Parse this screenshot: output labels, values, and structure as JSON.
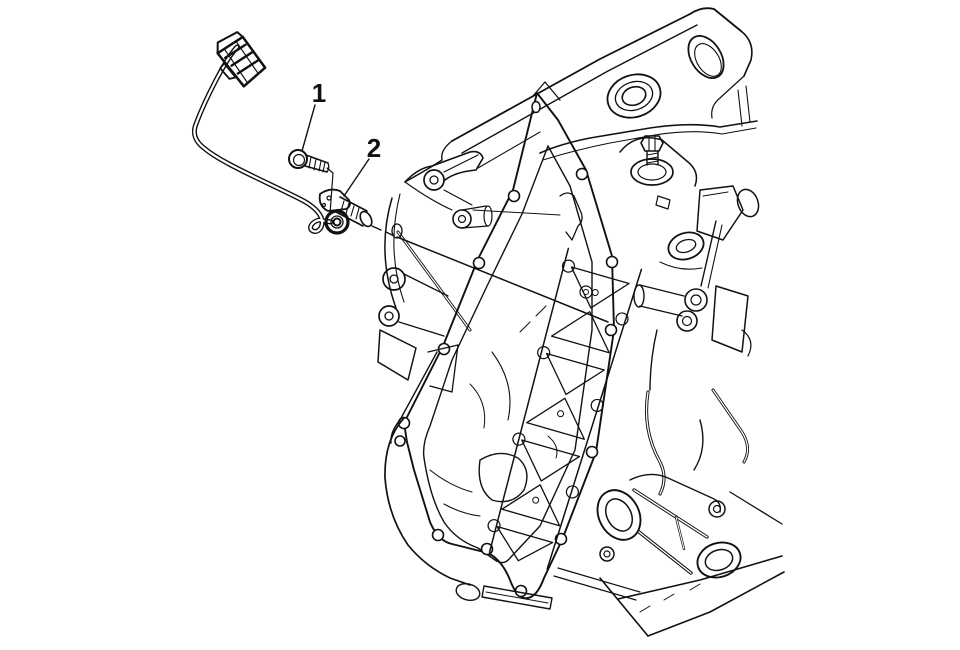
{
  "figure": {
    "type": "technical-line-illustration",
    "background_color": "#ffffff",
    "line_color": "#111111",
    "callouts": [
      {
        "label": "1",
        "part": "bolt"
      },
      {
        "label": "2",
        "part": "sensor"
      }
    ]
  }
}
